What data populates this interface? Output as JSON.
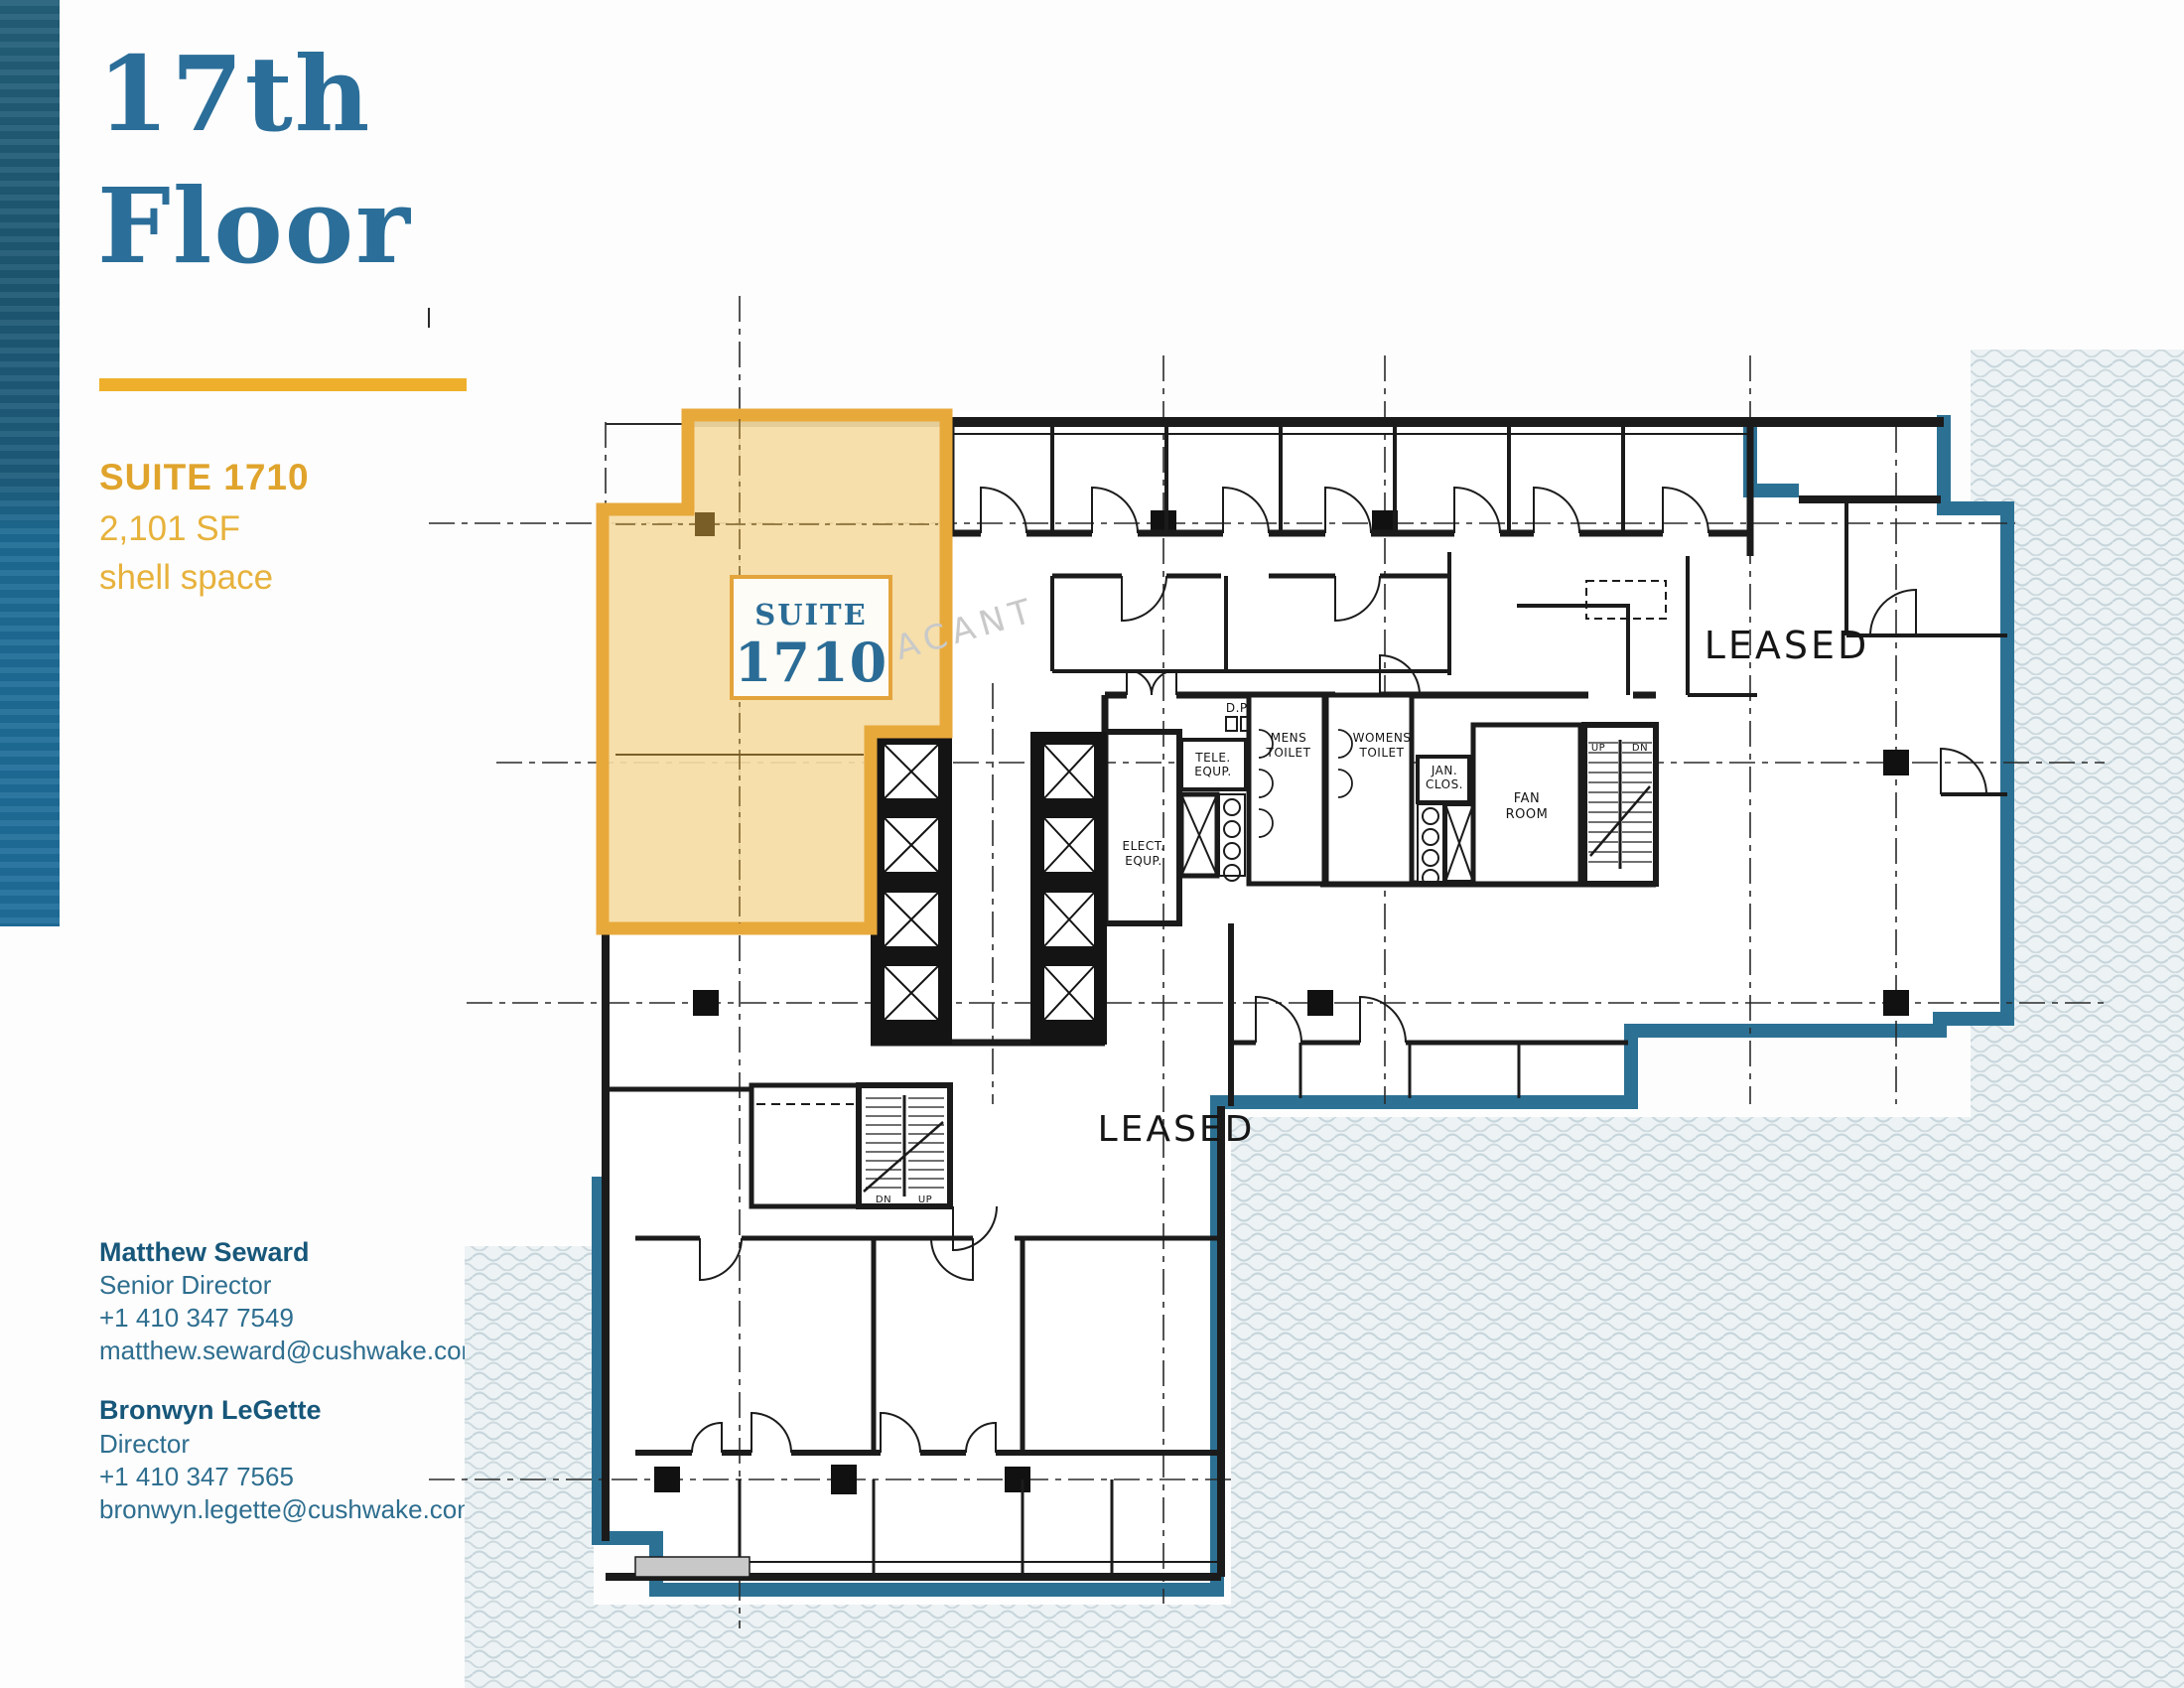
{
  "title": {
    "line1": "17th",
    "line2": "Floor"
  },
  "suite_info": {
    "suite": "SUITE 1710",
    "area": "2,101 SF",
    "space_type": "shell space"
  },
  "contacts": [
    {
      "name": "Matthew Seward",
      "title": "Senior Director",
      "phone": "+1 410 347 7549",
      "email": "matthew.seward@cushwake.com"
    },
    {
      "name": "Bronwyn LeGette",
      "title": "Director",
      "phone": "+1 410 347 7565",
      "email": "bronwyn.legette@cushwake.com"
    }
  ],
  "plan": {
    "suite_box": {
      "line1": "SUITE",
      "line2": "1710"
    },
    "vacant": "VACANT",
    "leased_right": "LEASED",
    "leased_center": "LEASED",
    "rooms": {
      "elect_equip_1": "ELECT.",
      "elect_equip_2": "EQUP.",
      "tele_equip_1": "TELE.",
      "tele_equip_2": "EQUP.",
      "mens_toilet_1": "MENS",
      "mens_toilet_2": "TOILET",
      "womens_toilet_1": "WOMENS",
      "womens_toilet_2": "TOILET",
      "jan_clos_1": "JAN.",
      "jan_clos_2": "CLOS.",
      "fan_room_1": "FAN",
      "fan_room_2": "ROOM",
      "dp": "D.P."
    },
    "stairs": {
      "up": "UP",
      "dn": "DN",
      "up2": "UP",
      "dn2": "DN"
    }
  },
  "colors": {
    "accent_gold": "#eeb02c",
    "suite_fill": "#f5dca4",
    "suite_border": "#e8a93b",
    "title_blue": "#2b6e99",
    "outline_blue": "#2c7194",
    "contact_teal": "#17577a",
    "wave_stroke": "#c7d6dc"
  }
}
